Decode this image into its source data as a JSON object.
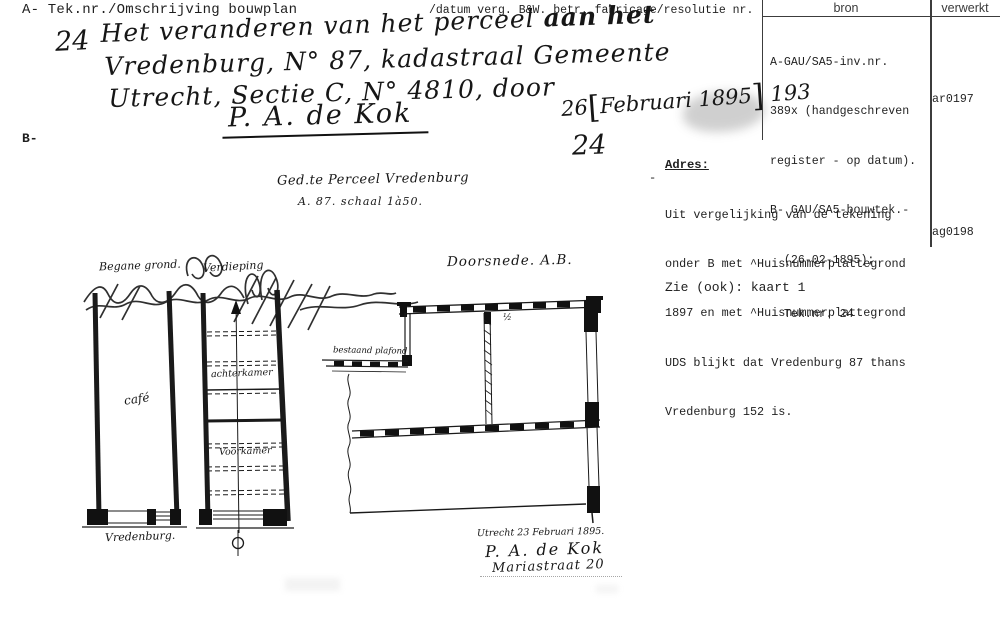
{
  "page": {
    "header_left": "A- Tek.nr./Omschrijving bouwplan",
    "header_right": "/datum verg. B&W. betr. fabricage/resolutie nr.",
    "margin_mark_b": "B-"
  },
  "bron_table": {
    "col_bron": "bron",
    "col_verwerkt": "verwerkt",
    "bron_lines": [
      "A-GAU/SA5-inv.nr.",
      "389x (handgeschreven",
      "register - op datum).",
      "B- GAU/SA5-bouwtek.-",
      "  (26-02-1895);",
      "  Tek.nr. 24"
    ],
    "verwerkt_code_1": "ar0197",
    "verwerkt_code_2": "ag0198"
  },
  "description": {
    "number": "24",
    "line1a": "Het veranderen van het perceel ",
    "line1b": "aan het",
    "line2": "Vredenburg, N° 87, kadastraal Gemeente",
    "line3": "Utrecht, Sectie C, N° 4810, door",
    "line4": "P. A. de Kok",
    "date_day": "26",
    "bracket_open": "[",
    "date_mid": "Februari 1895",
    "bracket_close": "]",
    "date_tail": "193",
    "number2": "24"
  },
  "adres": {
    "label": "Adres:",
    "dash": "-",
    "lines": [
      "Uit vergelijking van de tekening",
      "onder B met ^Huisnummerplattegrond",
      "1897 en met ^Huisnummerplattegrond",
      "UDS blijkt dat Vredenburg 87 thans",
      "Vredenburg 152 is."
    ],
    "zie_ook": "Zie (ook): kaart 1"
  },
  "drawing": {
    "title_line1": "Ged.te Perceel Vredenburg",
    "title_line2": "A. 87. schaal 1à50.",
    "plan_left_label": "Begane grond.",
    "plan_right_label": "Verdieping",
    "room_cafe": "café",
    "room_achterkamer": "achterkamer",
    "room_voorkamer": "Voorkamer",
    "street_label": "Vredenburg.",
    "section_title": "Doorsnede. A.B.",
    "section_note": "bestaand plafond",
    "section_half": "½",
    "sig_place_date": "Utrecht 23 Februari 1895.",
    "sig_name": "P. A. de Kok",
    "sig_address": "Mariastraat 20"
  }
}
